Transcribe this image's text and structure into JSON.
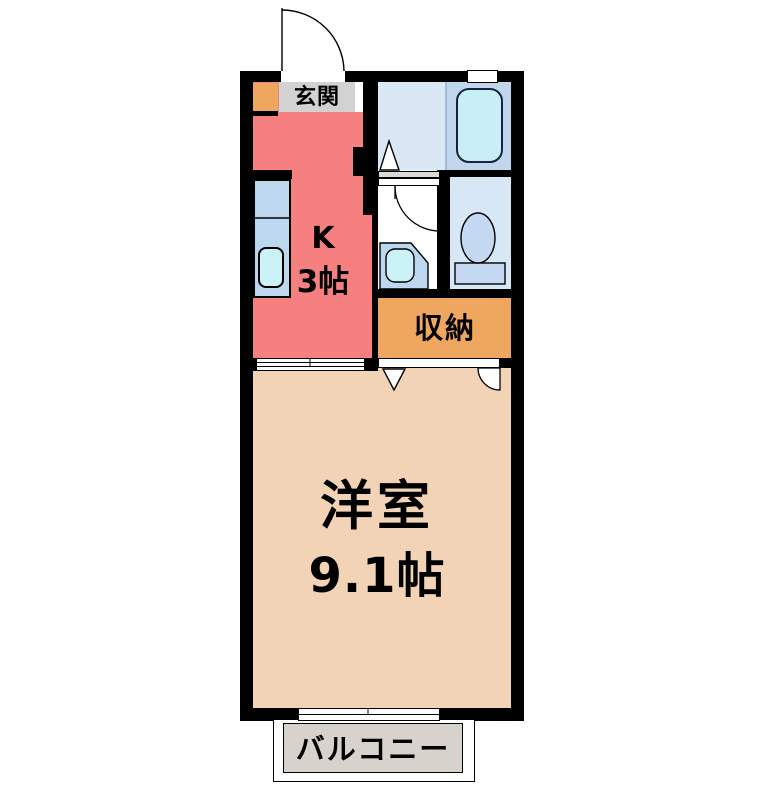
{
  "floor_plan": {
    "rooms": {
      "genkan": {
        "label": "玄関",
        "color": "#d2d2d2"
      },
      "kitchen": {
        "label": "K",
        "size": "3帖",
        "color": "#f6807f"
      },
      "bathroom": {
        "color_left": "#d9e8f4",
        "color_right": "#bfd6ed",
        "bathtub_color": "#c8eff6"
      },
      "toilet": {
        "color": "#d7e7f6"
      },
      "storage": {
        "label": "収納",
        "color": "#efa75f"
      },
      "main_room": {
        "label": "洋室",
        "size": "9.1帖",
        "color": "#f2d3b5"
      },
      "balcony": {
        "label": "バルコニー",
        "color": "#d8d2cd"
      }
    },
    "colors": {
      "wall": "#000000",
      "fixture_blue": "#bdd7ef",
      "toilet_fixture": "#c5daf2",
      "water_cyan": "#caf2f7",
      "background": "#ffffff"
    }
  }
}
